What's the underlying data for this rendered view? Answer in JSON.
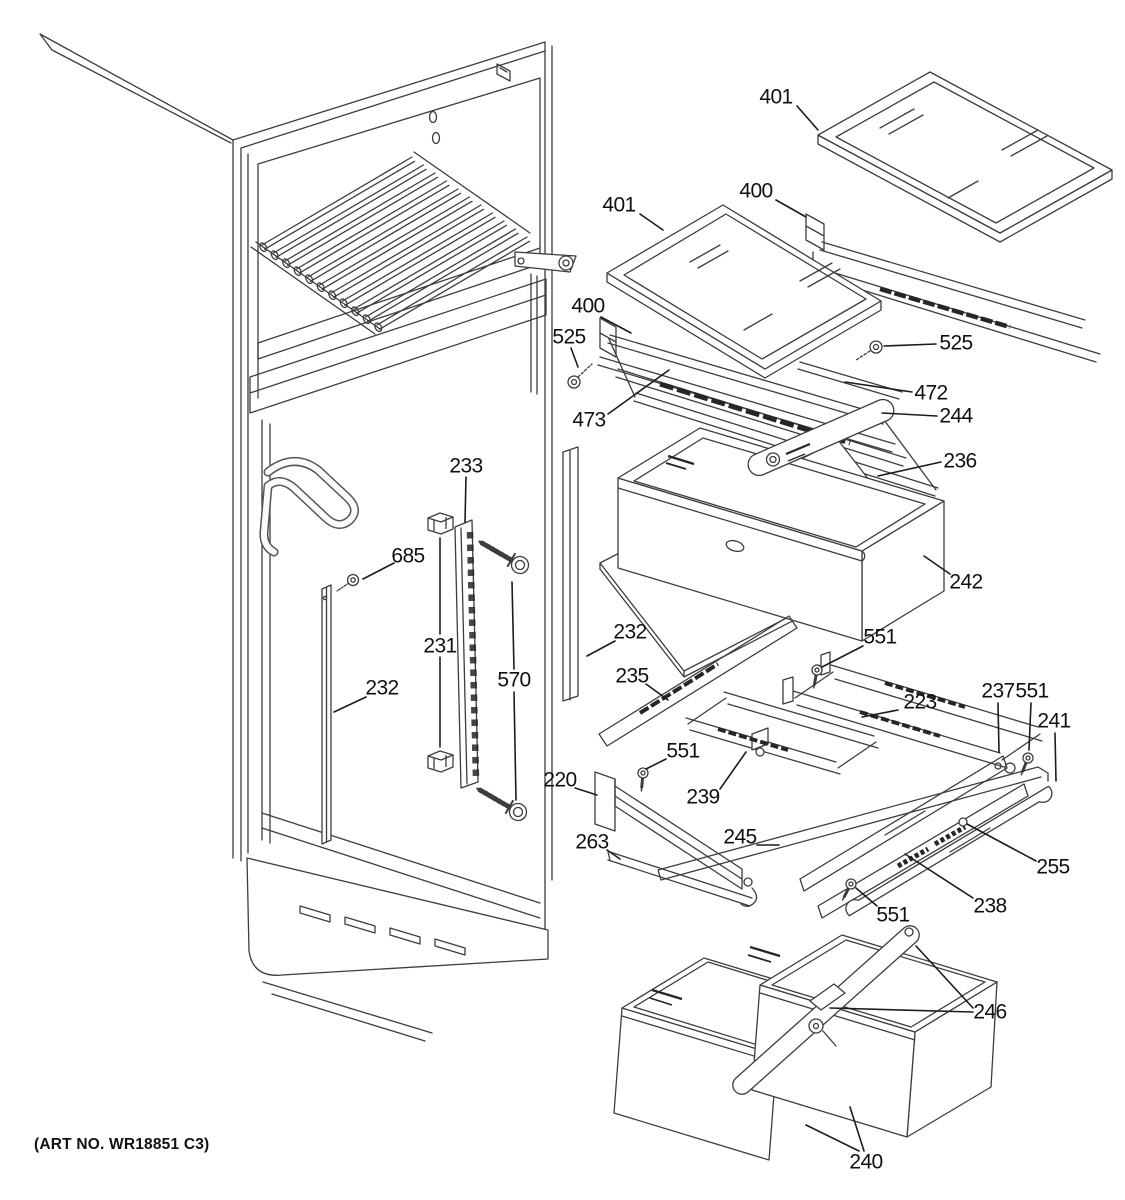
{
  "figure": {
    "type": "exploded-parts-diagram",
    "subject": "refrigerator fresh-food shelves section",
    "art_no": "(ART NO. WR18851 C3)",
    "callouts": [
      {
        "id": "401-right",
        "label": "401",
        "x": 776,
        "y": 97
      },
      {
        "id": "400-right",
        "label": "400",
        "x": 756,
        "y": 191
      },
      {
        "id": "401-left",
        "label": "401",
        "x": 619,
        "y": 205
      },
      {
        "id": "400-left",
        "label": "400",
        "x": 588,
        "y": 306
      },
      {
        "id": "525-left",
        "label": "525",
        "x": 569,
        "y": 337
      },
      {
        "id": "525-right",
        "label": "525",
        "x": 956,
        "y": 343
      },
      {
        "id": "472",
        "label": "472",
        "x": 931,
        "y": 393
      },
      {
        "id": "473",
        "label": "473",
        "x": 589,
        "y": 420
      },
      {
        "id": "244",
        "label": "244",
        "x": 956,
        "y": 416
      },
      {
        "id": "236",
        "label": "236",
        "x": 960,
        "y": 461
      },
      {
        "id": "242",
        "label": "242",
        "x": 966,
        "y": 582
      },
      {
        "id": "233",
        "label": "233",
        "x": 466,
        "y": 466
      },
      {
        "id": "685",
        "label": "685",
        "x": 408,
        "y": 556
      },
      {
        "id": "231",
        "label": "231",
        "x": 440,
        "y": 646
      },
      {
        "id": "570",
        "label": "570",
        "x": 514,
        "y": 680
      },
      {
        "id": "232-left",
        "label": "232",
        "x": 382,
        "y": 688
      },
      {
        "id": "232-middle",
        "label": "232",
        "x": 630,
        "y": 632
      },
      {
        "id": "235",
        "label": "235",
        "x": 632,
        "y": 676
      },
      {
        "id": "551-top",
        "label": "551",
        "x": 880,
        "y": 637
      },
      {
        "id": "223",
        "label": "223",
        "x": 920,
        "y": 702
      },
      {
        "id": "237",
        "label": "237",
        "x": 998,
        "y": 691
      },
      {
        "id": "551-right",
        "label": "551",
        "x": 1032,
        "y": 691
      },
      {
        "id": "241",
        "label": "241",
        "x": 1054,
        "y": 721
      },
      {
        "id": "551-middle",
        "label": "551",
        "x": 683,
        "y": 751
      },
      {
        "id": "239",
        "label": "239",
        "x": 703,
        "y": 797
      },
      {
        "id": "220",
        "label": "220",
        "x": 560,
        "y": 780
      },
      {
        "id": "245",
        "label": "245",
        "x": 740,
        "y": 837
      },
      {
        "id": "263",
        "label": "263",
        "x": 592,
        "y": 842
      },
      {
        "id": "255",
        "label": "255",
        "x": 1053,
        "y": 867
      },
      {
        "id": "238",
        "label": "238",
        "x": 990,
        "y": 906
      },
      {
        "id": "551-bottom",
        "label": "551",
        "x": 893,
        "y": 915
      },
      {
        "id": "246",
        "label": "246",
        "x": 990,
        "y": 1012
      },
      {
        "id": "240",
        "label": "240",
        "x": 866,
        "y": 1162
      }
    ]
  }
}
